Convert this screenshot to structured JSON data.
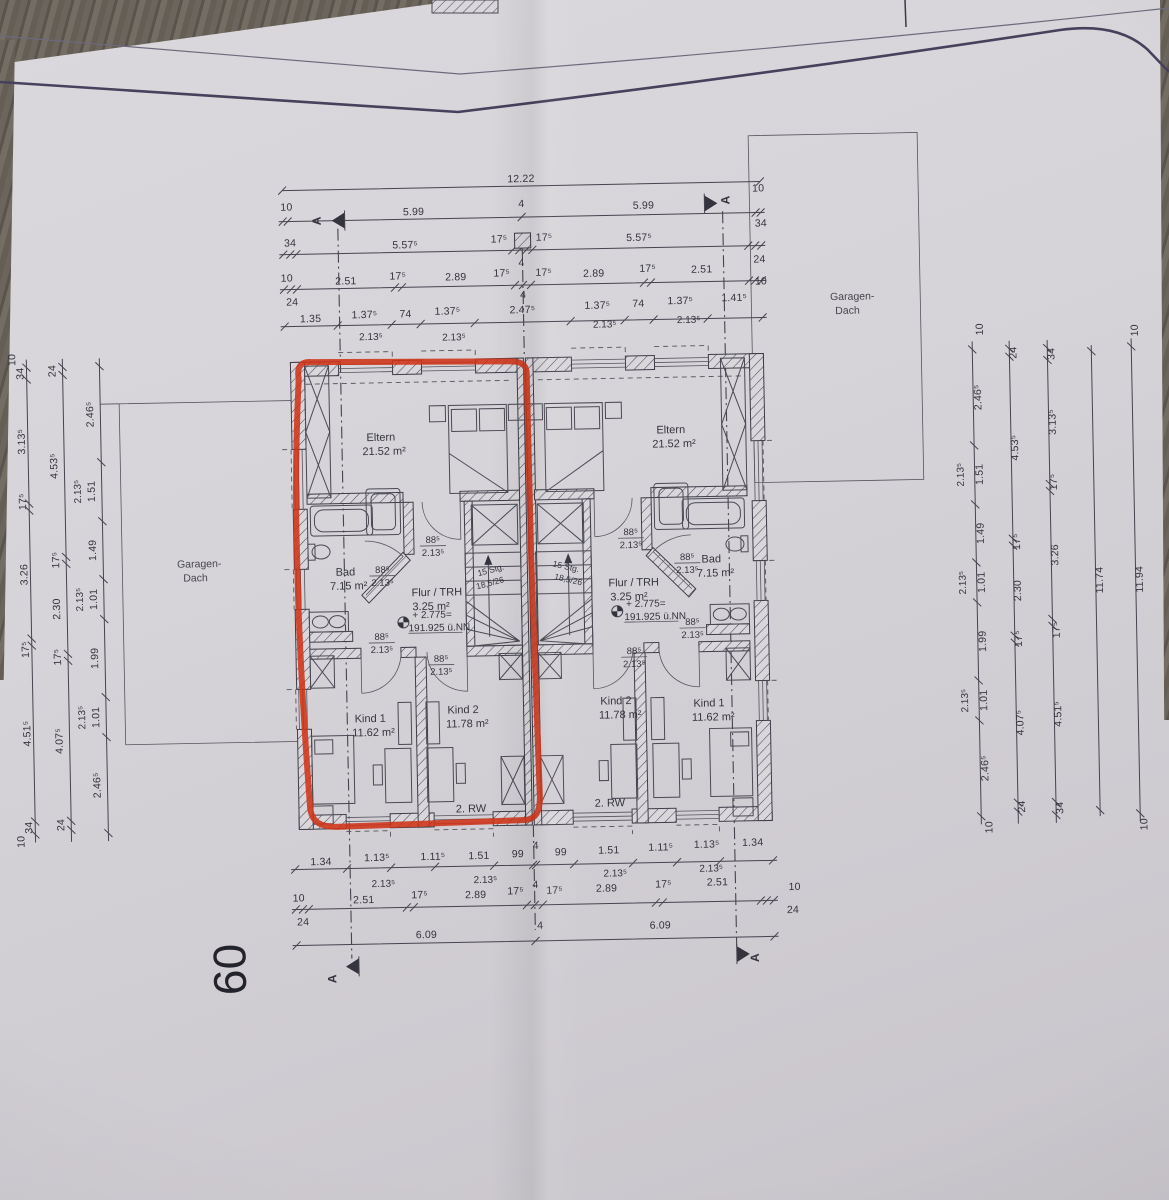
{
  "colors": {
    "paper": "#d7d5d9",
    "line": "#3e3d48",
    "red_marker": "#cf3317",
    "wood": "#675f55"
  },
  "dims": {
    "top": {
      "row1": [
        "12.22"
      ],
      "row2": [
        "5.99",
        "4",
        "5.99"
      ],
      "row3": [
        "5.57⁵",
        "17⁵",
        "4",
        "17⁵",
        "5.57⁵"
      ],
      "row4": [
        "2.51",
        "17⁵",
        "2.89",
        "17⁵",
        "4",
        "17⁵",
        "2.89",
        "17⁵",
        "2.51"
      ],
      "row5": [
        "1.35",
        "1.37⁵",
        "74",
        "1.37⁵",
        "2.47⁵",
        "1.37⁵",
        "74",
        "1.37⁵",
        "1.41⁵"
      ],
      "row5_sub": [
        "2.13⁵",
        "2.13⁵",
        "2.13⁵",
        "2.13⁵"
      ],
      "left_margin": [
        "10",
        "34",
        "10",
        "24"
      ],
      "right_margin": [
        "10",
        "34",
        "24",
        "10"
      ]
    },
    "bottom": {
      "row1": [
        "1.34",
        "1.13⁵",
        "1.11⁵",
        "1.51",
        "99",
        "4",
        "99",
        "1.51",
        "1.11⁵",
        "1.13⁵",
        "1.34"
      ],
      "row1_sub": [
        "2.13⁵",
        "2.13⁵",
        "2.13⁵",
        "2.13⁵"
      ],
      "row2": [
        "2.51",
        "17⁵",
        "2.89",
        "17⁵",
        "4",
        "17⁵",
        "2.89",
        "17⁵",
        "2.51"
      ],
      "row3": [
        "6.09",
        "4",
        "6.09"
      ],
      "left_margin": [
        "10",
        "24"
      ],
      "right_margin": [
        "10",
        "24"
      ]
    },
    "left": {
      "col1": [
        "34",
        "3.13⁵",
        "17⁵",
        "3.26",
        "17⁵",
        "4.51⁵",
        "34"
      ],
      "col2": [
        "24",
        "4.53⁵",
        "17⁵",
        "2.30",
        "17⁵",
        "4.07⁵",
        "24"
      ],
      "col3": [
        "2.46⁵",
        "1.51",
        "1.49",
        "1.01",
        "1.99",
        "1.01",
        "2.46⁵"
      ],
      "col3_sub": [
        "2.13⁵",
        "2.13⁵",
        "2.13⁵"
      ],
      "margins": [
        "10",
        "10"
      ]
    },
    "right": {
      "col1": [
        "2.46⁵",
        "1.51",
        "1.49",
        "1.01",
        "1.99",
        "1.01",
        "2.46⁵"
      ],
      "col1_sub": [
        "2.13⁵",
        "2.13⁵",
        "2.13⁵"
      ],
      "col2": [
        "24",
        "4.53⁵",
        "17⁵",
        "2.30",
        "17⁵",
        "4.07⁵",
        "24"
      ],
      "col3": [
        "34",
        "3.13⁵",
        "17⁵",
        "3.26",
        "17⁵",
        "4.51⁵",
        "34"
      ],
      "totals": [
        "11.74",
        "11.94"
      ],
      "margins": [
        "10",
        "10",
        "10",
        "10"
      ]
    }
  },
  "rooms": {
    "eltern": {
      "name": "Eltern",
      "area": "21.52 m²"
    },
    "bad": {
      "name": "Bad",
      "area": "7.15 m²"
    },
    "flur": {
      "name": "Flur / TRH",
      "area": "3.25 m²"
    },
    "kind1": {
      "name": "Kind 1",
      "area": "11.62 m²"
    },
    "kind2": {
      "name": "Kind 2",
      "area": "11.78 m²"
    }
  },
  "doors": {
    "w": "88⁵",
    "h": "2.13⁵"
  },
  "stairs": {
    "l1": "15 Stg.",
    "l2": "18,5/26"
  },
  "level": {
    "l1": "+ 2.775=",
    "l2": "191.925 ü.NN"
  },
  "misc": {
    "rw": "2. RW",
    "garage1": "Garagen-",
    "garage2": "Dach",
    "section": "A",
    "handwritten": "09"
  }
}
